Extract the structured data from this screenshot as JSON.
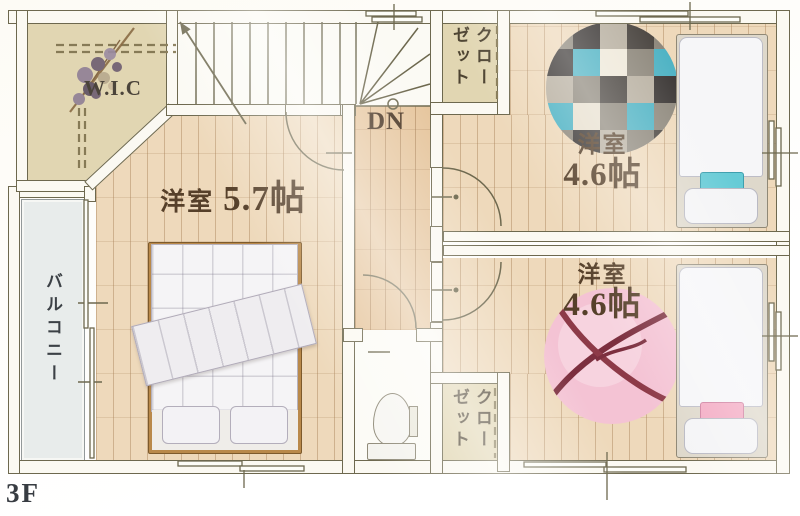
{
  "floor_label": "3F",
  "labels": {
    "wic": "W.I.C",
    "down": "DN",
    "balcony": "バルコニー",
    "closet_top": "クローゼット",
    "closet_bottom": "クローゼット"
  },
  "rooms": {
    "main": {
      "type": "洋室",
      "size": "5.7帖"
    },
    "top_right": {
      "type": "洋室",
      "size": "4.6帖"
    },
    "bottom_right": {
      "type": "洋室",
      "size": "4.6帖"
    }
  },
  "colors": {
    "wood_floor": "#eed9bb",
    "hall_floor": "#e6c69e",
    "closet_floor": "#e1d6b2",
    "wall_line": "#6d684e",
    "label_text": "#56402a",
    "balcony_fill": "#e8eceb",
    "rug_teal": "#4fb3c4",
    "rug_dark": "#3c3836",
    "rug_pink": "#f4c3d4",
    "ribbon": "#7c2f3f",
    "pillow_teal": "#66cbd6",
    "pillow_pink": "#f3a9c2"
  }
}
